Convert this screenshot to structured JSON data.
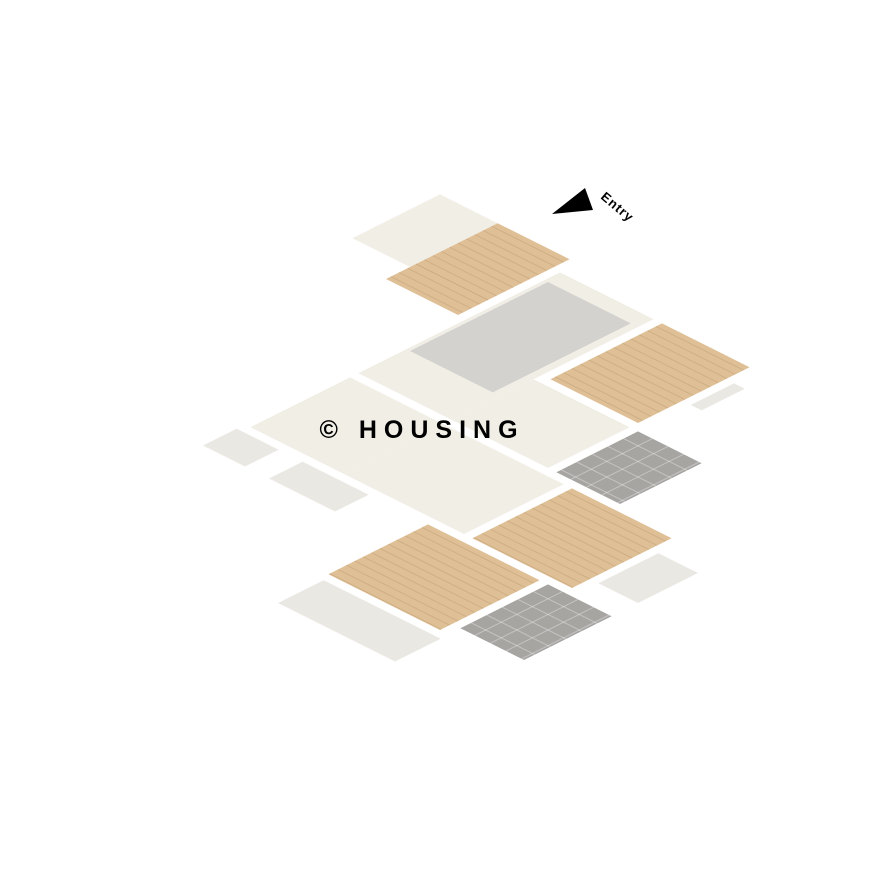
{
  "page": {
    "title": "3D Isometric Floor Plan Render",
    "background": "#ffffff"
  },
  "labels": {
    "entry": "Entry",
    "watermark": "© HOUSING"
  },
  "palette": {
    "wallTop": "#6a695e",
    "wallFaceA": "#f7f4ee",
    "wallFaceB": "#e9e4db",
    "floorCream": "#f1eee6",
    "floorWood": "#dfc096",
    "floorTile": "#a6a5a2",
    "floorBalc": "#eae8e2",
    "rug": "#c7c7c5",
    "rugLight": "#d3d2cf",
    "sofa": "#d9aa72",
    "sofaBack": "#c99c63",
    "sofaLight": "#ecd2a4",
    "pillow": "#f6f4ee",
    "bedBlue": "#2d62a8",
    "bedBlueD": "#24508c",
    "pillowBlue": "#5b87b8",
    "headboardBlue": "#2f4f7d",
    "bedTeal": "#a9d8da",
    "tealPillow": "#c3e2e3",
    "tealFold": "#8fc6c9",
    "navy": "#3c5a82",
    "navyD": "#2f4868",
    "navyFrame": "#41628c",
    "navyBlanket": "#35597f",
    "headboardNavy": "#33557e",
    "bedCoral": "#e87b60",
    "coralD": "#d96a50",
    "coralPillow": "#f0a68c",
    "cabBlue": "#abd0e3",
    "cabBlueD": "#92bcd2",
    "cabUpper": "#bcdaea",
    "white": "#f4f2ec",
    "whiteSide": "#dfdcd4",
    "woodDark": "#57463a",
    "woodDark2": "#473a2f",
    "deskWood": "#d4a872",
    "deskWoodD": "#c0945f",
    "tableWhite": "#fafaf7",
    "tableSide": "#e7e5df",
    "chairBlue": "#a9cfe2",
    "chairBlueD": "#8fb9cf",
    "plate": "#2f4f78",
    "tvScreen": "#222222",
    "art": "#3d6390",
    "glass": "#ccdde3",
    "doorFace": "#fcfbf8",
    "doorFrame": "#b9b2a6",
    "railing": "#1d1d1d",
    "mat": "#c9a26d",
    "benchTop": "#e2e1de",
    "benchSide": "#bcbbb8",
    "hob": "#3a3a3a",
    "pot": "#1f1f1f",
    "mirror": "#9fd0d4",
    "plant": "#6f9c5e",
    "planter": "#8a6f52",
    "arrow": "#dd8672",
    "entryText": "#c98472",
    "watermark": "rgba(255,255,255,0.55)",
    "tileDark": "#8f8f8c",
    "sinkSteel": "#d8d8d6",
    "lamp": "#39506e",
    "woodLine": "rgba(140,95,55,0.18)",
    "tileLine": "rgba(255,255,255,0.35)"
  },
  "scene": {
    "bedrooms": 3,
    "bathrooms": 2,
    "balconies": 5,
    "rooms": [
      "entry-foyer",
      "store-room",
      "living-room",
      "dining-area",
      "kitchen",
      "bedroom-blue",
      "master-bedroom-teal",
      "bedroom-coral",
      "bathroom-common",
      "bathroom-bottom",
      "corridor"
    ],
    "furniture": [
      "l-shaped-sofa",
      "coffee-table",
      "accent-chairs",
      "tv-unit",
      "dining-table-6-chairs",
      "kitchen-counters",
      "fridge",
      "hob-with-pots",
      "double-bed-blue",
      "double-bed-teal",
      "double-bed-coral",
      "wardrobes",
      "nightstands",
      "foot-bench",
      "round-mirror",
      "study-desk-chair",
      "toilet",
      "wash-basin",
      "shower",
      "foyer-bench",
      "doormat",
      "iron-railings"
    ]
  }
}
